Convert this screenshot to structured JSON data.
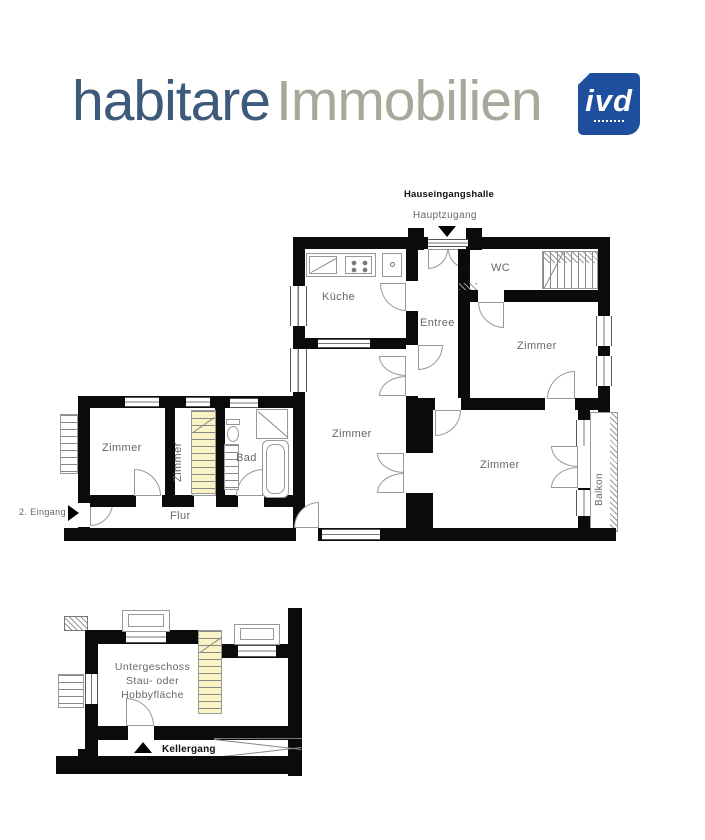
{
  "header": {
    "brand_primary": "habitare",
    "brand_secondary": "Immobilien",
    "badge_text": "ivd"
  },
  "colors": {
    "brand_primary": "#3d5a7b",
    "brand_secondary": "#a7a79a",
    "badge_bg": "#1d4f9e",
    "wall": "#0b0b0b",
    "stair_highlight": "#faf3c5",
    "label_gray": "#676767"
  },
  "main_floor": {
    "entrance_hall_label": "Hauseingangshalle",
    "main_entrance_label": "Hauptzugang",
    "second_entrance_label": "2. Eingang",
    "rooms": {
      "kitchen": "Küche",
      "entree": "Entree",
      "wc": "WC",
      "wc_symbol": "[9]",
      "room_center": "Zimmer",
      "room_top_right": "Zimmer",
      "room_bottom_right": "Zimmer",
      "room_left": "Zimmer",
      "room_left_small": "Zimmer",
      "bathroom": "Bad",
      "hallway": "Flur",
      "balcony": "Balkon"
    }
  },
  "basement": {
    "room_label": [
      "Untergeschoss",
      "Stau- oder",
      "Hobbyfläche"
    ],
    "corridor_label": "Kellergang"
  }
}
